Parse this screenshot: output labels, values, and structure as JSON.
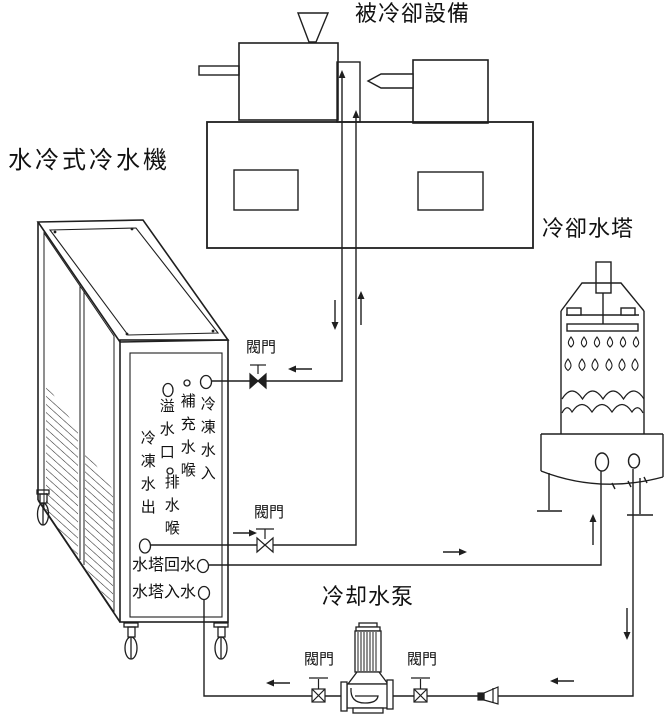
{
  "diagram": {
    "colors": {
      "line": "#1f1f1f",
      "background": "#ffffff"
    },
    "titles": {
      "chiller": "水冷式冷水機",
      "cooled_equipment": "被冷卻設備",
      "cooling_tower": "冷卻水塔",
      "cooling_pump": "冷却水泵"
    },
    "valves": {
      "top": "閥門",
      "middle": "閥門",
      "pump_left": "閥門",
      "pump_right": "閥門"
    },
    "chiller_ports": {
      "chilled_water_in": "冷凍水入",
      "makeup_hose": "補充水喉",
      "overflow": "溢水口",
      "drain_hose": "排水喉",
      "chilled_water_out": "冷凍水出",
      "tower_return": "水塔回水",
      "tower_inlet": "水塔入水"
    }
  }
}
